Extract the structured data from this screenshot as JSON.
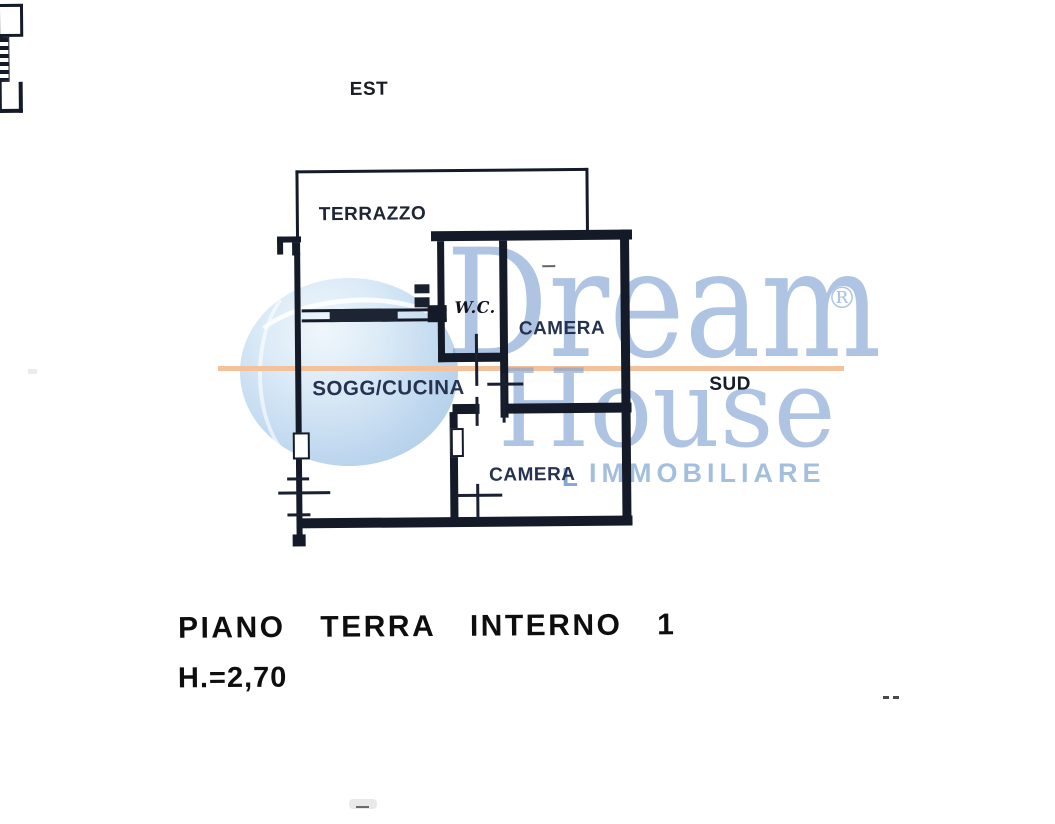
{
  "compass": {
    "est": "EST",
    "sud": "SUD"
  },
  "rooms": {
    "terrazzo": "TERRAZZO",
    "wc": "W.C.",
    "camera_top": "CAMERA",
    "sogg_cucina": "SOGG/CUCINA",
    "camera_bottom": "CAMERA"
  },
  "caption": {
    "line1": "PIANO TERRA INTERNO 1",
    "line2": "H.=2,70"
  },
  "watermark": {
    "word1": "Dream",
    "word2": "House",
    "word3": "IMMOBILIARE",
    "registered": "®",
    "swash": "L",
    "serif_text_color": "#7da0d0",
    "immobiliare_color": "#94b4d8",
    "accent_line_color": "#f3c29d",
    "globe_color_light": "#f0f6fc",
    "globe_color_dark": "#a9c7e5"
  },
  "plan_style": {
    "wall_color": "#151a29",
    "label_color": "#26324f",
    "background": "#ffffff"
  }
}
